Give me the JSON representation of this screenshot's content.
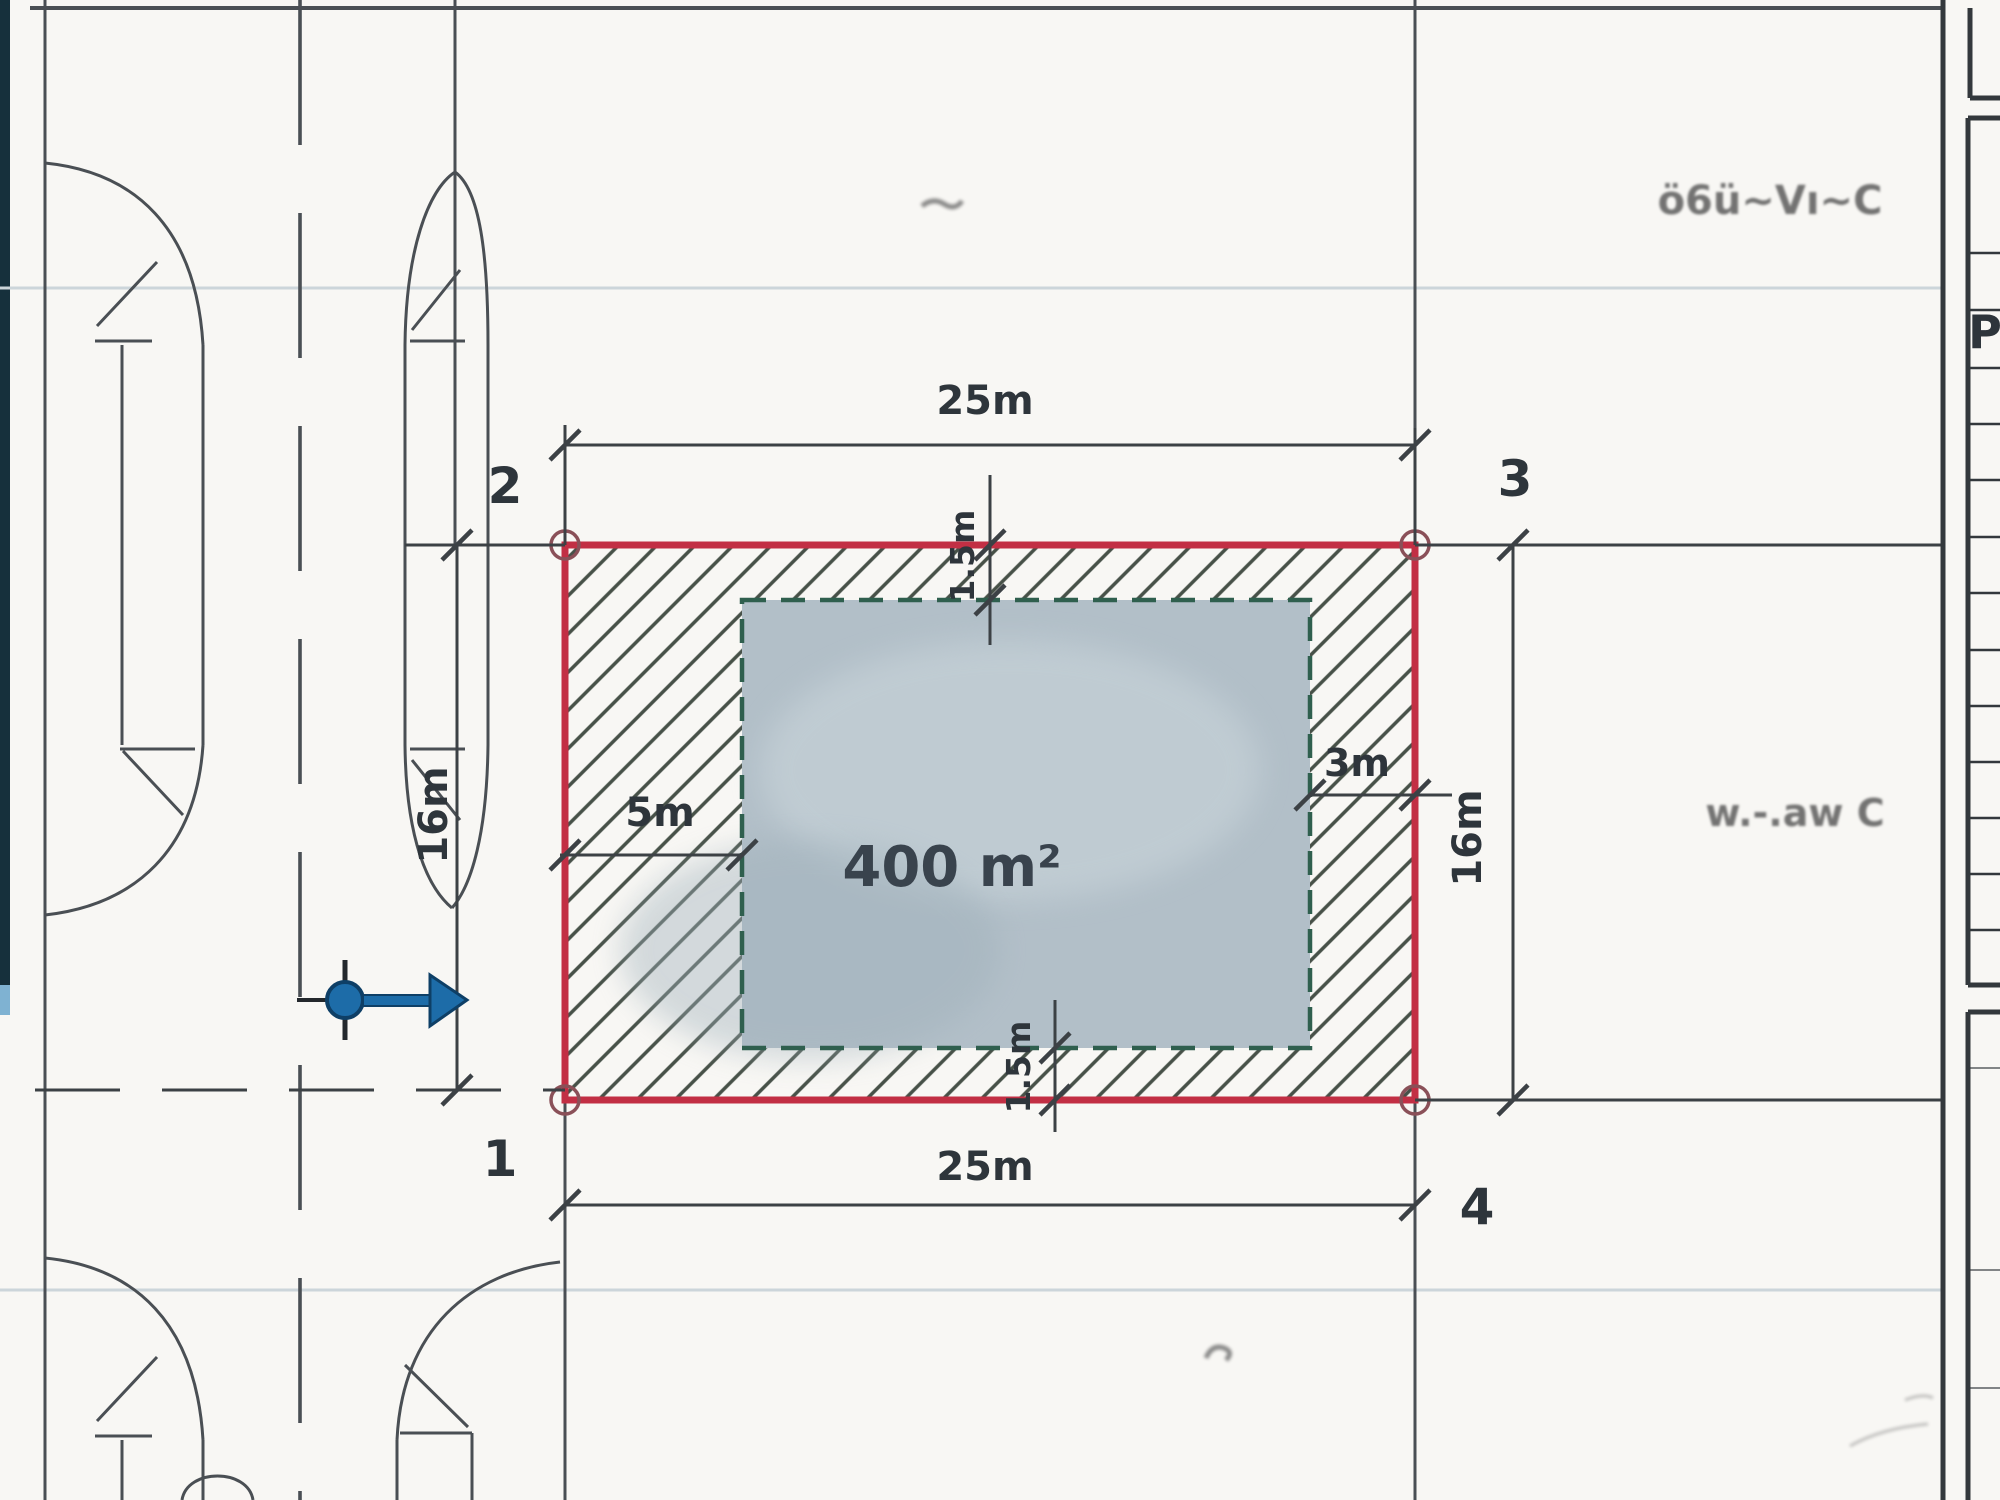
{
  "plan": {
    "area_label": "400 m²",
    "corners": {
      "one": "1",
      "two": "2",
      "three": "3",
      "four": "4"
    },
    "dimensions": {
      "width_top": "25m",
      "width_bottom": "25m",
      "height_left": "16m",
      "height_right": "16m",
      "setback_left": "5m",
      "setback_right": "3m",
      "setback_top": "1.5m",
      "setback_bottom": "1.5m"
    }
  },
  "titleblock": {
    "visible_letter": "P"
  },
  "annotations": {
    "handwriting_top_right": "ö6ü~Vı~C",
    "handwriting_mid_right": "w.-.aw C"
  },
  "colors": {
    "plot_boundary_red": "#c22f44",
    "building_fill": "#b2bfc8",
    "building_border_green": "#2f5f4e",
    "hatch": "#475148",
    "entrance_arrow_blue": "#1d6ca8",
    "drawing_line": "#44494e",
    "faint_line": "#ccd5da",
    "scan_band_teal": "#16303c"
  }
}
